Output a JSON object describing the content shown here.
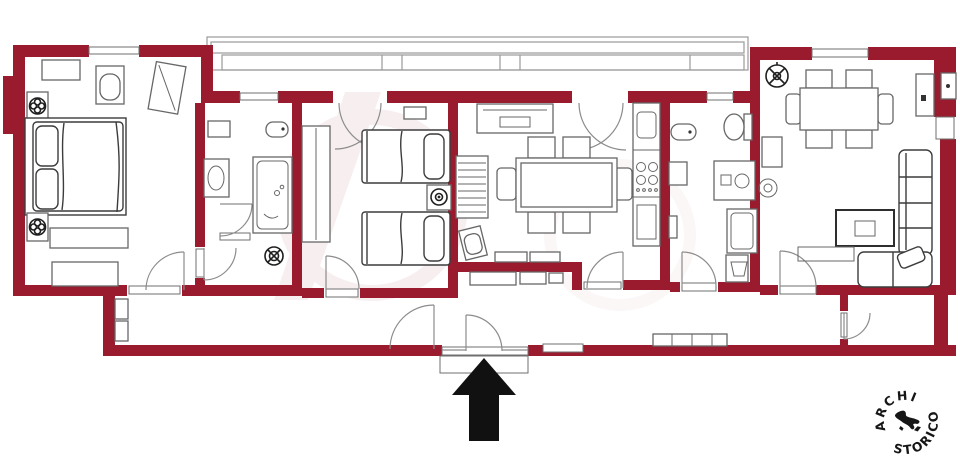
{
  "page": {
    "type": "apartment-floor-plan",
    "background": "#ffffff"
  },
  "colors": {
    "wall": "#9a1b2e",
    "furniture-line": "#676767",
    "sketch-line": "#3c3c3c",
    "door-arc": "#8c8c8c",
    "window-line": "#6f6f6f",
    "balcony-line": "#9a9a9a",
    "entrance-arrow": "#111111",
    "seal-ink": "#161616"
  },
  "seal": {
    "text_top": "MARCHIO",
    "text_bottom": "STORICO",
    "icon": "italy-silhouette-icon"
  },
  "entrance": {
    "icon": "entrance-arrow-icon",
    "direction": "up"
  },
  "icons": {
    "fan": "ceiling-fan-icon",
    "lamp": "bedside-lamp-icon",
    "drain": "floor-drain-icon",
    "hob": "stove-burners-icon"
  }
}
